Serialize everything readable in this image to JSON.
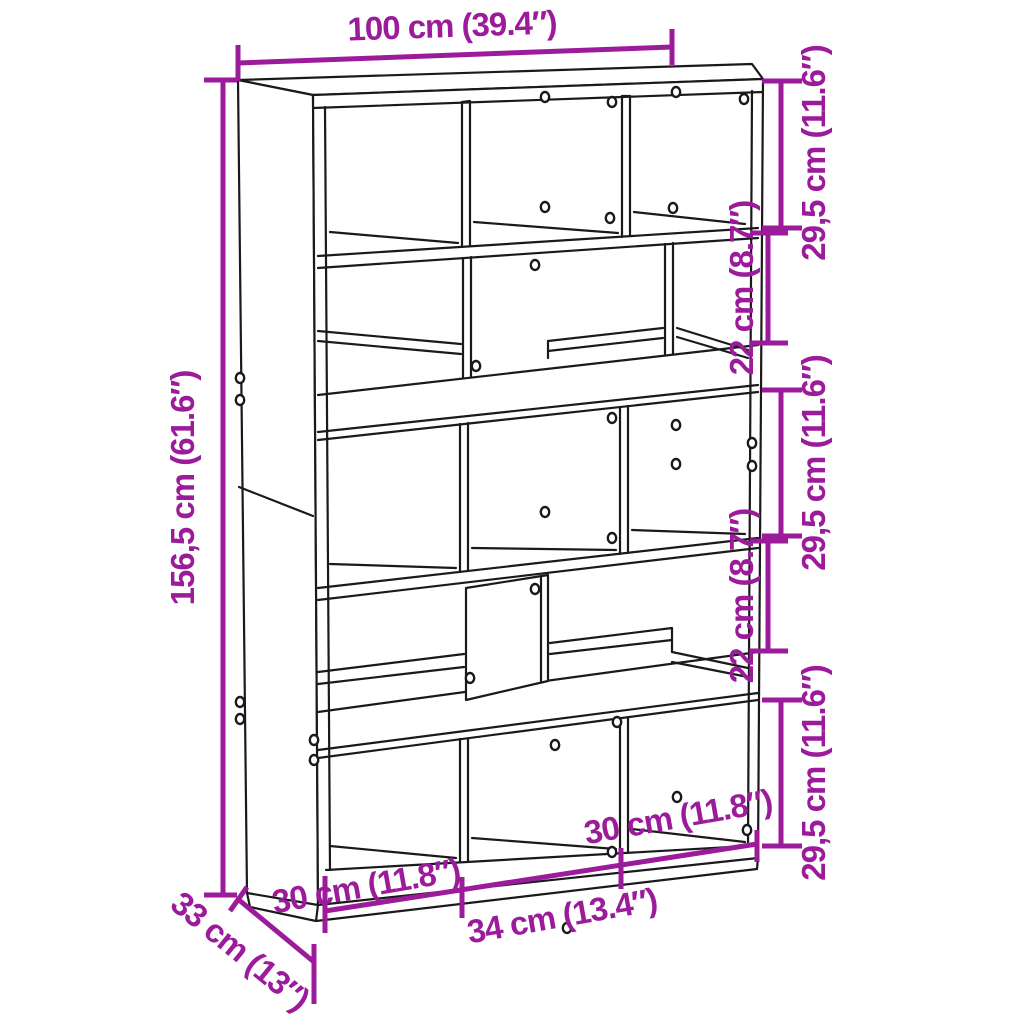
{
  "diagram": {
    "product": "bookcase-room-divider-dimension-drawing",
    "colors": {
      "dimension_accent": "#9B1B9B",
      "line": "#1A1A1A",
      "background": "#FFFFFF"
    },
    "dims": {
      "width": "100 cm (39.4″)",
      "height": "156,5 cm (61.6″)",
      "depth": "33 cm (13″)",
      "right_sections": [
        "29,5 cm (11.6″)",
        "22 cm (8.7″)",
        "29,5 cm (11.6″)",
        "22 cm (8.7″)",
        "29,5 cm (11.6″)"
      ],
      "bottom_widths": [
        "30 cm (11.8″)",
        "34 cm (13.4″)",
        "30 cm (11.8″)"
      ]
    }
  }
}
